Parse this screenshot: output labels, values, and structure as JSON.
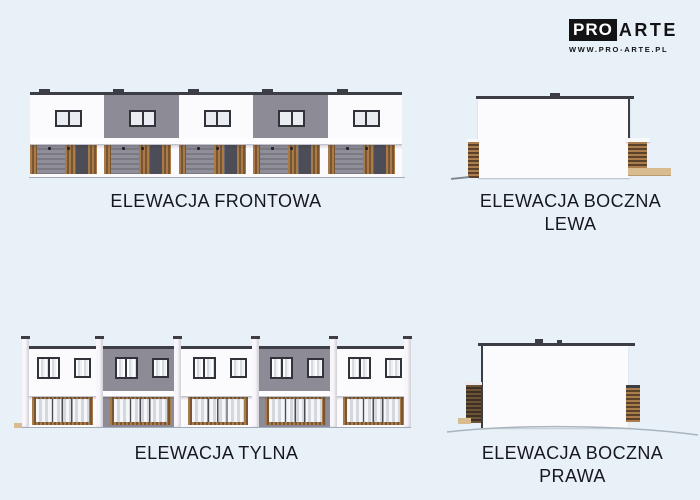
{
  "page": {
    "width": 700,
    "height": 500
  },
  "logo": {
    "pro": "PRO",
    "arte": "ARTE",
    "url": "WWW.PRO-ARTE.PL"
  },
  "captions": {
    "front": "ELEWACJA FRONTOWA",
    "side_left_line1": "ELEWACJA BOCZNA",
    "side_left_line2": "LEWA",
    "rear": "ELEWACJA TYLNA",
    "side_right_line1": "ELEWACJA BOCZNA",
    "side_right_line2": "PRAWA"
  },
  "elevations": {
    "front": {
      "unit_count": 5,
      "facade_pattern": [
        "white",
        "gray",
        "white",
        "gray",
        "white"
      ]
    },
    "rear": {
      "unit_count": 5,
      "facade_pattern": [
        "white",
        "gray",
        "white",
        "gray",
        "white"
      ]
    }
  },
  "colors": {
    "background": "#e8f1f8",
    "facade_white": "#fbfafc",
    "facade_gray": "#8d8b95",
    "roof_dark": "#3d3d45",
    "wood": "#a97a4a",
    "wood_dark": "#7a5630",
    "door_dark": "#4d4d57",
    "beige": "#d9bb90",
    "pane_light": "#e9ecf1",
    "label_text": "#17171f",
    "logo_black": "#131316"
  }
}
